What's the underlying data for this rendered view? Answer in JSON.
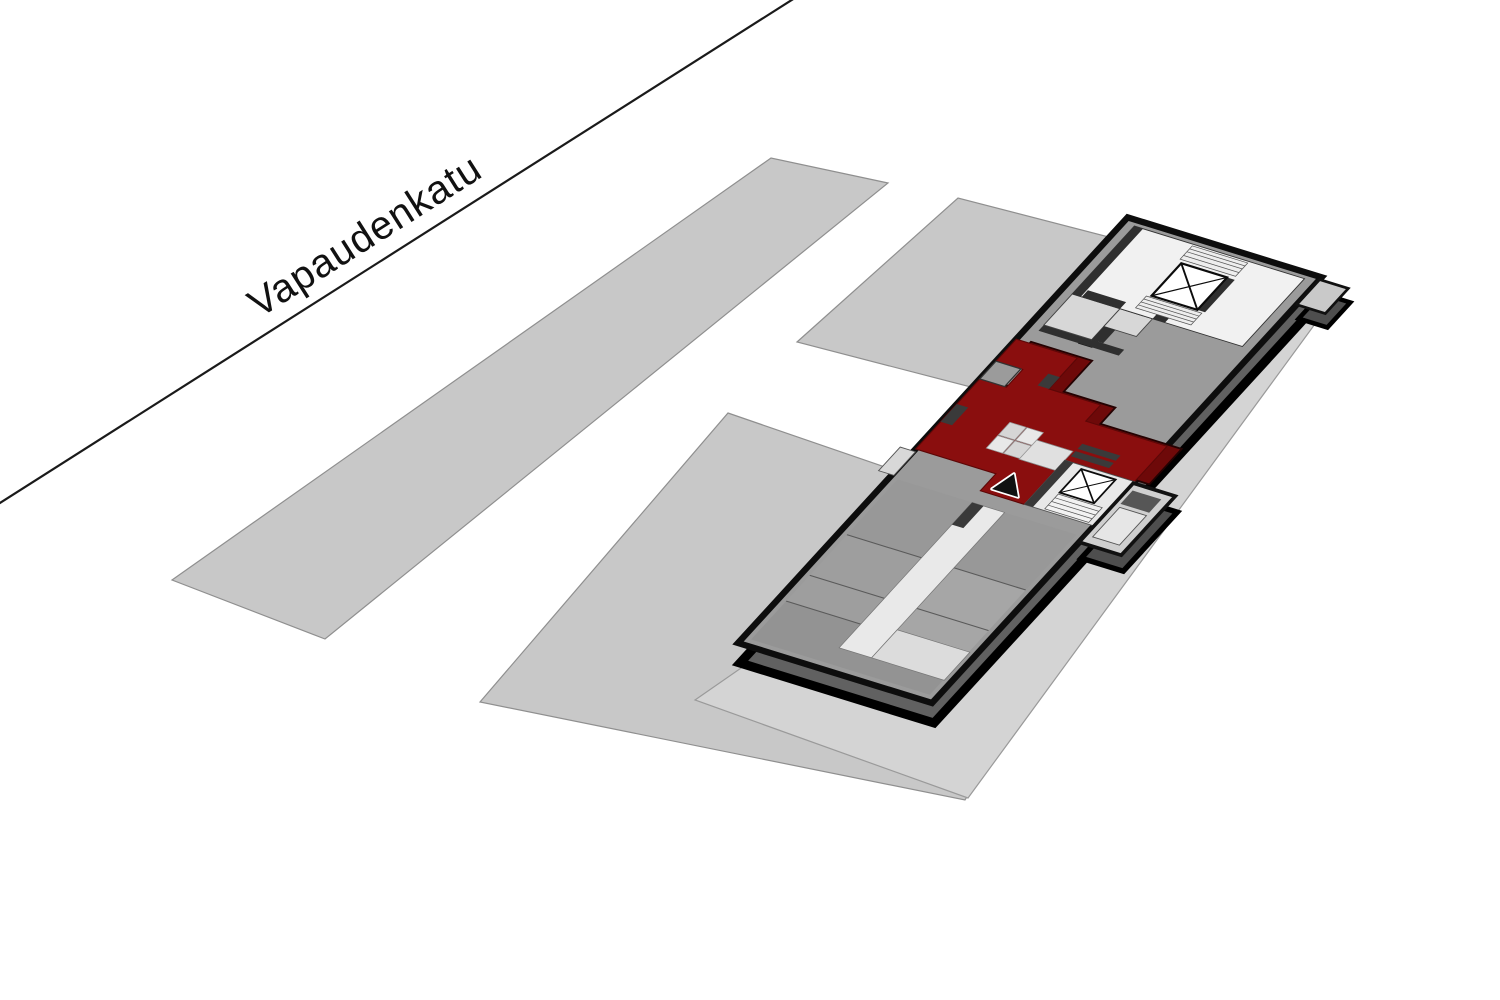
{
  "diagram": {
    "kind": "apartment-location-axonometric",
    "street": {
      "label": "Vapaudenkatu"
    },
    "legend": {
      "highlighted_unit": "selected apartment",
      "marker": "location-triangle"
    },
    "colors": {
      "background": "#ffffff",
      "street_line": "#1a1a1a",
      "neighbor_block": "#c8c8c8",
      "neighbor_block_stroke": "#8f8f8f",
      "ground_plate": "#d4d4d4",
      "ground_plate_stroke": "#9a9a9a",
      "roof": "#9b9b9b",
      "building_outline": "#0d0d0d",
      "slab_side": "#616161",
      "highlight_unit": "#8a0e0e",
      "highlight_unit_side": "#6e0909",
      "corridor": "#e9e9e9",
      "stair_floor": "#f1f1f1",
      "room_light": "#d7d7d7",
      "wall_dark": "#2f2f2f",
      "vent_dark": "#3f3f3f",
      "marker_fill": "#111111",
      "marker_stroke": "#ffffff"
    },
    "icons": [
      "elevator-x-icon",
      "stairs-icon",
      "location-triangle-icon"
    ]
  }
}
